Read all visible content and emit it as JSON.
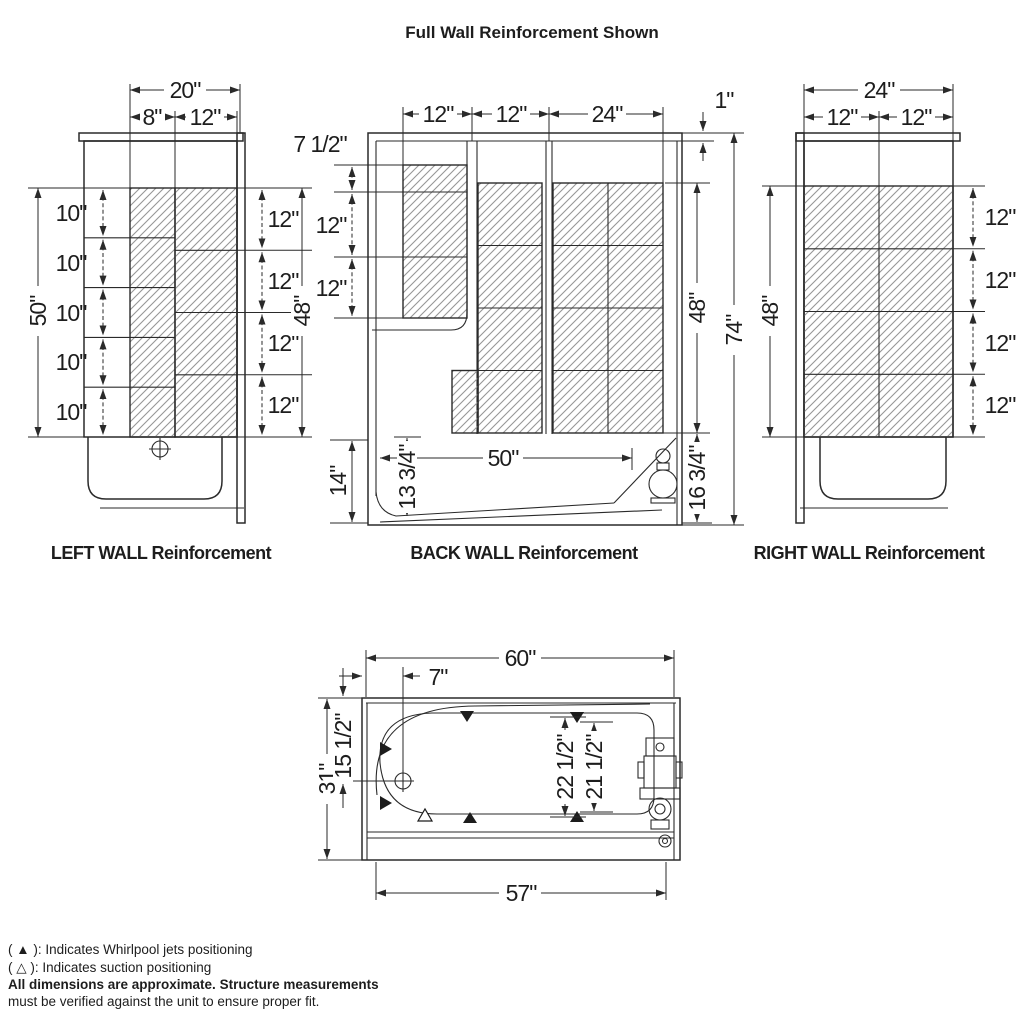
{
  "title": "Full Wall Reinforcement Shown",
  "colors": {
    "line": "#2a2a2a",
    "hatch": "#979797",
    "background": "#ffffff"
  },
  "walls": {
    "left": {
      "label": "LEFT WALL Reinforcement",
      "top_total": "20\"",
      "top_segs": [
        "8\"",
        "12\""
      ],
      "left_total": "50\"",
      "left_rows": [
        "10\"",
        "10\"",
        "10\"",
        "10\"",
        "10\""
      ],
      "right_rows": [
        "12\"",
        "12\"",
        "12\"",
        "12\""
      ],
      "right_total": "48\""
    },
    "back": {
      "label": "BACK WALL Reinforcement",
      "top_segs": [
        "12\"",
        "12\"",
        "24\""
      ],
      "top_gap": "1\"",
      "left_top": "7 1/2\"",
      "left_rows": [
        "12\"",
        "12\""
      ],
      "bottom_left_height": "14\"",
      "apron_height": "13 3/4\"",
      "deck_span": "50\"",
      "hatch_height": "48\"",
      "total_height": "74\"",
      "bottom_right_height": "16 3/4\""
    },
    "right": {
      "label": "RIGHT WALL Reinforcement",
      "top_total": "24\"",
      "top_segs": [
        "12\"",
        "12\""
      ],
      "left_total": "48\"",
      "right_rows": [
        "12\"",
        "12\"",
        "12\"",
        "12\""
      ]
    }
  },
  "plan": {
    "width_overall": "60\"",
    "drain_offset": "7\"",
    "depth_overall": "31\"",
    "drain_inset": "15 1/2\"",
    "jet_span_outer": "22 1/2\"",
    "jet_span_inner": "21 1/2\"",
    "width_base": "57\""
  },
  "legend": {
    "jets_line": "( ▲ ): Indicates Whirlpool jets positioning",
    "suction_line": "( △ ): Indicates suction positioning",
    "note_bold": "All dimensions are approximate. Structure measurements",
    "note_rest": "must be verified against the unit to ensure proper fit."
  }
}
